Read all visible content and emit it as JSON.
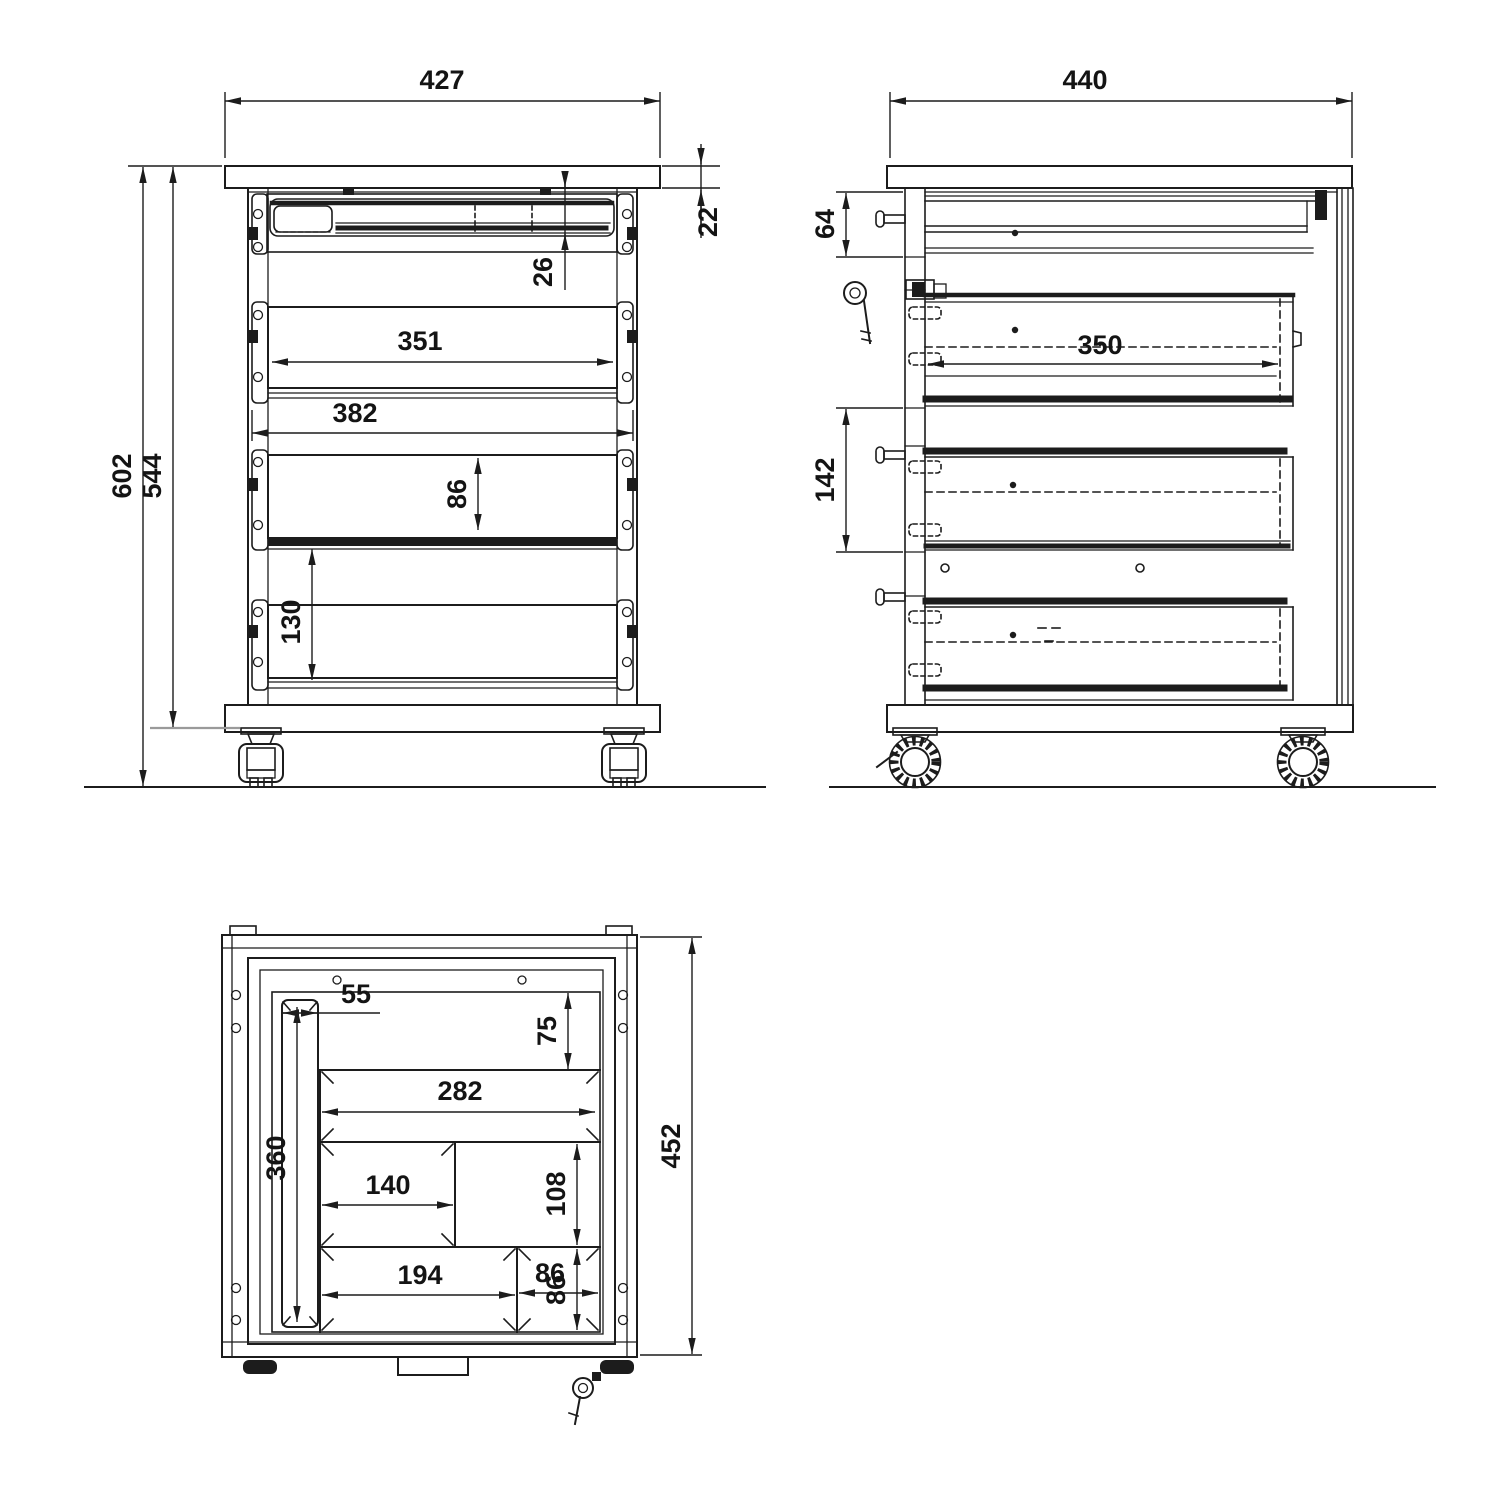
{
  "palette": {
    "background": "#ffffff",
    "line": "#1c1c1c",
    "muted_line": "#9a9a9a"
  },
  "front_view": {
    "label": "front-elevation",
    "dims": {
      "overall_width": "427",
      "top_panel_thickness": "22",
      "pencil_tray_depth": "26",
      "drawer_opening_width": "351",
      "drawer_front_width": "382",
      "middle_drawer_front_height": "86",
      "lower_drawer_spacing": "130",
      "overall_height": "602",
      "carcass_height": "544"
    }
  },
  "side_view": {
    "label": "side-elevation",
    "dims": {
      "overall_depth": "440",
      "pencil_drawer_front_height": "64",
      "drawer_inner_depth": "350",
      "drawer_pitch": "142"
    }
  },
  "top_view": {
    "label": "plan-view",
    "dims": {
      "pen_channel_width": "55",
      "front_clearance": "75",
      "large_tray_length": "282",
      "pen_channel_length": "360",
      "small_tray_length": "140",
      "middle_row_depth": "108",
      "bottom_tray_length": "194",
      "corner_tray_length": "86",
      "corner_tray_depth": "86",
      "overall_inner_depth": "452"
    }
  }
}
